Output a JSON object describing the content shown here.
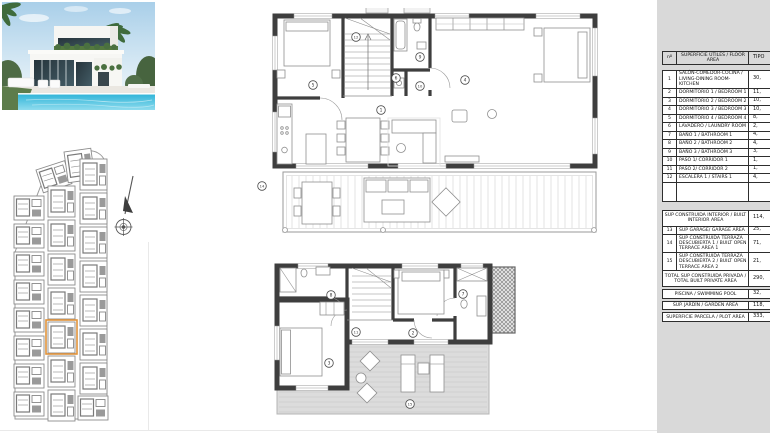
{
  "colors": {
    "panel_bg": "#d9d9d9",
    "wall": "#3e3e3e",
    "terrace_fill": "#dcdcdc"
  },
  "site_plan": {
    "highlight_color": "#e0923a"
  },
  "upper_plan": {
    "room_labels": [
      {
        "n": "5",
        "x": 313,
        "y": 85
      },
      {
        "n": "12",
        "x": 356,
        "y": 37
      },
      {
        "n": "9",
        "x": 420,
        "y": 57
      },
      {
        "n": "6",
        "x": 396,
        "y": 78
      },
      {
        "n": "10",
        "x": 420,
        "y": 86
      },
      {
        "n": "4",
        "x": 465,
        "y": 80
      },
      {
        "n": "1",
        "x": 381,
        "y": 110
      },
      {
        "n": "14",
        "x": 262,
        "y": 186
      }
    ]
  },
  "lower_plan": {
    "room_labels": [
      {
        "n": "8",
        "x": 331,
        "y": 295
      },
      {
        "n": "7",
        "x": 463,
        "y": 294
      },
      {
        "n": "11",
        "x": 356,
        "y": 332
      },
      {
        "n": "2",
        "x": 413,
        "y": 333
      },
      {
        "n": "3",
        "x": 329,
        "y": 363
      },
      {
        "n": "15",
        "x": 410,
        "y": 404
      }
    ]
  },
  "area_table": {
    "col_headers": [
      "nº",
      "SUPERFICIE ÚTILES / FLOOR AREA",
      "TIPO"
    ],
    "rows": [
      {
        "n": "1",
        "label": "SALÓN-COMEDOR-COCINA / LIVING-DINING ROOM-KITCHEN",
        "value": "30,"
      },
      {
        "n": "2",
        "label": "DORMITORIO 1 / BEDROOM 1",
        "value": "11,"
      },
      {
        "n": "3",
        "label": "DORMITORIO 2 / BEDROOM 2",
        "value": "10,"
      },
      {
        "n": "4",
        "label": "DORMITORIO 3 / BEDROOM 3",
        "value": "10,"
      },
      {
        "n": "5",
        "label": "DORMITORIO 4 / BEDROOM 4",
        "value": "8,"
      },
      {
        "n": "6",
        "label": "LAVADERO / LAUNDRY ROOM",
        "value": "2,"
      },
      {
        "n": "7",
        "label": "BAÑO 1 / BATHROOM 1",
        "value": "4,"
      },
      {
        "n": "8",
        "label": "BAÑO 2 / BATHROOM 2",
        "value": "4,"
      },
      {
        "n": "9",
        "label": "BAÑO 3 / BATHROOM 3",
        "value": "3,"
      },
      {
        "n": "10",
        "label": "PASO 1/ CORRIDOR 1",
        "value": "1,"
      },
      {
        "n": "11",
        "label": "PASO 2/ CORRIDOR 2",
        "value": "1,"
      },
      {
        "n": "12",
        "label": "ESCALERA 1 / STAIRS 1",
        "value": "4,"
      },
      {
        "n": "",
        "label": "",
        "value": "",
        "h": 20
      }
    ],
    "interior": {
      "label": "SUP CONSTRUIDA INTERIOR / BUILT INTERIOR AREA",
      "value": "114,"
    },
    "rows2": [
      {
        "n": "13",
        "label": "SUP GARAGE/ GARAGE AREA",
        "value": "25,"
      },
      {
        "n": "14",
        "label": "SUP CONSTRUIDA TERRAZA DESCUBIERTA 1 / BUILT OPEN TERRACE AREA 1",
        "value": "71,"
      },
      {
        "n": "15",
        "label": "SUP CONSTRUIDA TERRAZA DESCUBIERTA 2 / BUILT OPEN TERRACE AREA 2",
        "value": "21,"
      }
    ],
    "total": {
      "label": "TOTAL SUP CONSTRUIDA PRIVADA / TOTAL BUILT PRIVATE AREA",
      "value": "290,"
    },
    "pool": {
      "label": "PISCINA / SWIMMING POOL",
      "value": "32,"
    },
    "garden": {
      "label": "SUP. JARDÍN / GARDEN AREA",
      "value": "118,"
    },
    "plot": {
      "label": "SUPERFICIE PARCELA / PLOT AREA",
      "value": "333,"
    }
  }
}
